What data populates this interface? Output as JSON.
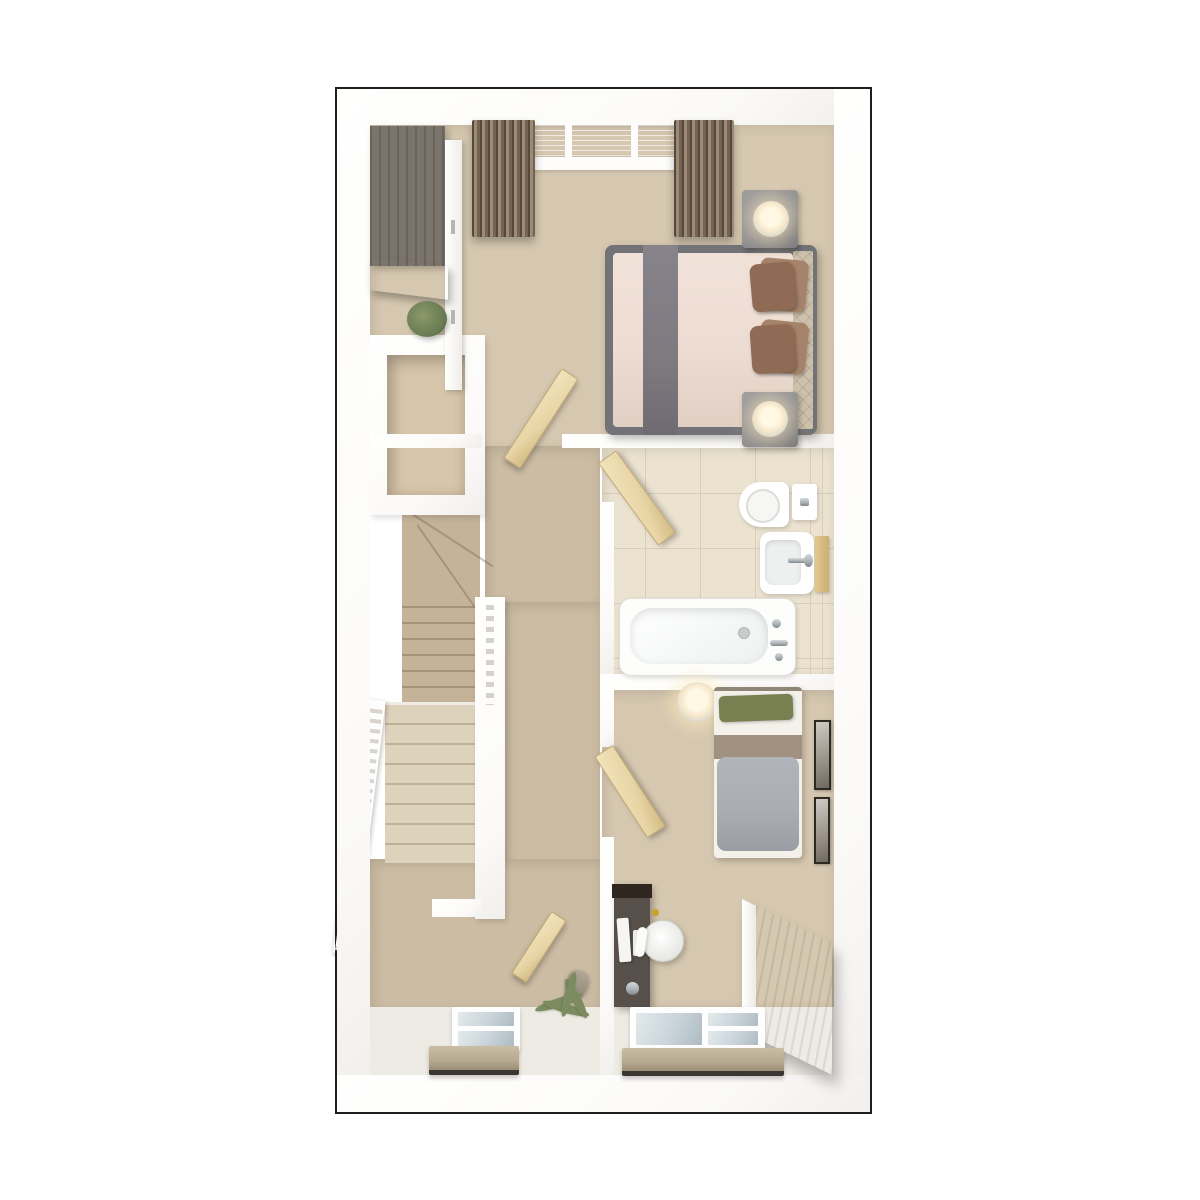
{
  "plan": {
    "type": "3d-floorplan-top-view",
    "floors_shown": 1
  },
  "palette": {
    "page_bg": "#ffffff",
    "plan_border": "#1f1f1f",
    "wall": "#fbfaf8",
    "carpet": "#d6c8b0",
    "carpet_deep": "#cbbca3",
    "floor_light": "#edebe4",
    "closet_floor": "#d8c6aa",
    "tile": "#ebe2d0",
    "tile_grout": "#d8cdb9",
    "stair_upper": "#c5b399",
    "stair_lower": "#ddd2bc",
    "wood_door": "#e8d5a6",
    "wardrobe_top": "#7b746c",
    "wardrobe_wood": "#6d5a43",
    "bed_frame": "#737377",
    "bed_duvet": "#eddcd2",
    "bed_runner": "#7d7b80",
    "headboard": "#cec1ac",
    "pillow_a": "#8f6b55",
    "pillow_b": "#a5836a",
    "nightstand": "#929194",
    "glow": "#f7e9cb",
    "plant": "#6a7a52",
    "palm": "#7d8c60",
    "pillow_green": "#788051",
    "band_taupe": "#a09181",
    "duvet_grey": "#a9adb2",
    "desk_body": "#57504a",
    "desk_top": "#2f2620",
    "wood_sideboard": "#8d7c64",
    "radiator": "#b7aa91",
    "radiator_edge": "#3a3732",
    "pane_blue": "#c9d4da",
    "curtain_light": "#9c8a74",
    "curtain_dark": "#55483c",
    "chrome": "#a9b0b4",
    "accent_gold": "#c9a227"
  },
  "rooms": {
    "main_bedroom": {
      "furniture": [
        "wardrobe",
        "plant",
        "double-bed",
        "grey-bed-runner",
        "brown-pillows",
        "tufted-headboard",
        "nightstand-with-lamp-top",
        "nightstand-with-lamp-bottom",
        "bay-window",
        "curtains-left",
        "curtains-right"
      ]
    },
    "landing": {
      "furniture": [
        "storage-closet",
        "staircase-upper-flight",
        "staircase-lower-flight",
        "banister-left",
        "banister-spindle-wall",
        "bedroom-door",
        "hall-door",
        "window",
        "radiator",
        "palm-plant"
      ]
    },
    "bathroom": {
      "furniture": [
        "door",
        "toilet",
        "cistern",
        "basin",
        "chrome-tap",
        "wood-shelf",
        "bathtub",
        "bath-taps",
        "tiled-floor"
      ]
    },
    "bedroom_2": {
      "furniture": [
        "pendant-lamp",
        "single-bed",
        "green-pillow",
        "grey-duvet",
        "wall-art-1",
        "wall-art-2",
        "door",
        "desk",
        "desk-chair",
        "sideboard",
        "window",
        "radiator"
      ]
    }
  }
}
